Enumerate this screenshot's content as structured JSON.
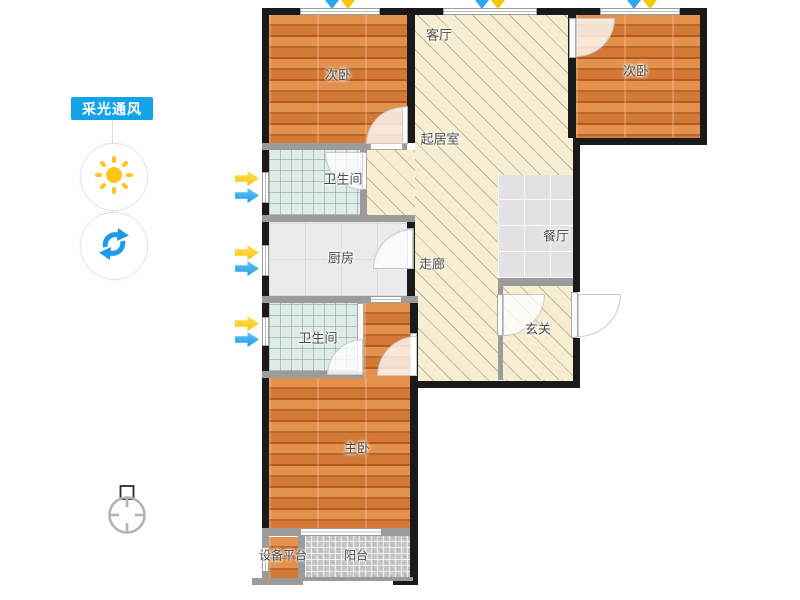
{
  "theme": {
    "accent": "#14a3e8",
    "arrow-yellow": "#f7c600",
    "arrow-blue": "#1e9ae8",
    "sun": "#ffc51c",
    "wall-dark": "#1a1a1a",
    "wall-light": "#9b9b9b",
    "wood": "#d9803e",
    "hatch": "#f6eed2",
    "label": "#4d4d4d"
  },
  "sidebar": {
    "toggle_label": "采光通风",
    "icons": [
      "sun-icon",
      "refresh-icon"
    ]
  },
  "floorplan": {
    "labels": {
      "bedroom_tl": "次卧",
      "living": "客厅",
      "sitting": "起居室",
      "bedroom_tr": "次卧",
      "bath_upper": "卫生间",
      "kitchen": "厨房",
      "corridor": "走廊",
      "dining": "餐厅",
      "entry": "玄关",
      "bath_lower": "卫生间",
      "master": "主卧",
      "equipment": "设备平台",
      "balcony": "阳台"
    },
    "compass": "compass-icon"
  }
}
